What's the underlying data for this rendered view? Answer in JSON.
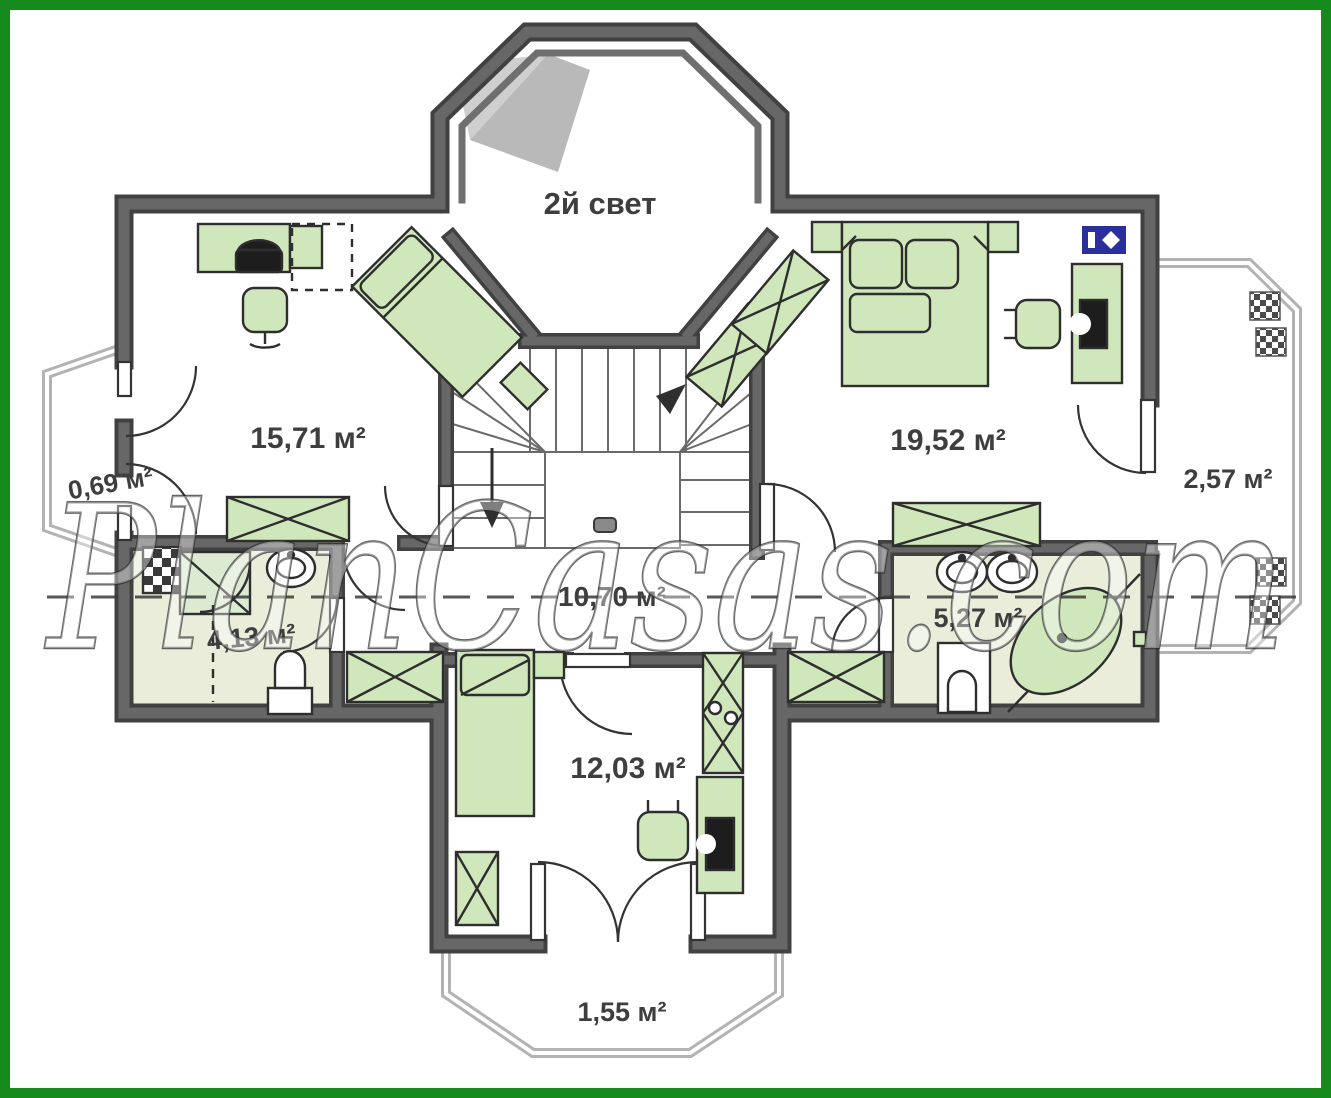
{
  "plan": {
    "tower_label": "2й свет",
    "watermark": "PlanCasas.com",
    "rooms": [
      {
        "id": "left-bedroom",
        "area": "15,71 м²"
      },
      {
        "id": "right-bedroom",
        "area": "19,52 м²"
      },
      {
        "id": "left-bay",
        "area": "0,69 м²"
      },
      {
        "id": "right-balcony",
        "area": "2,57 м²"
      },
      {
        "id": "left-bathroom",
        "area": "4,13 м²"
      },
      {
        "id": "hallway",
        "area": "10,70 м²"
      },
      {
        "id": "right-bathroom",
        "area": "5,27 м²"
      },
      {
        "id": "bottom-bedroom",
        "area": "12,03 м²"
      },
      {
        "id": "bottom-balcony",
        "area": "1,55 м²"
      }
    ],
    "colors": {
      "frame_green": "#178a1d",
      "wall_dark": "#414141",
      "wall_gray": "#676767",
      "furniture_green": "#cfe7ba",
      "bath_floor": "#e9edda",
      "logo_blue": "#2b2f9e",
      "label_gray": "#3e3e3e"
    }
  }
}
